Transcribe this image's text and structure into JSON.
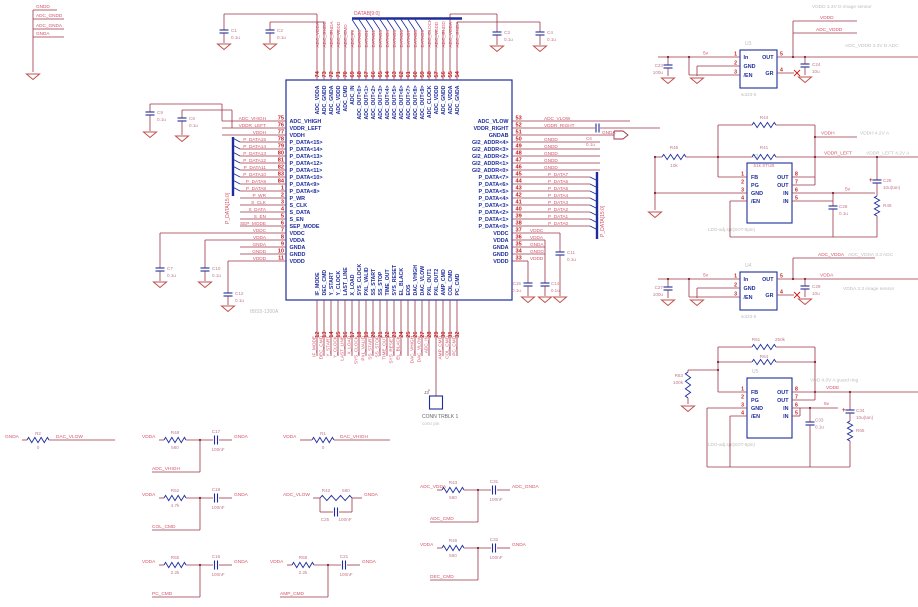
{
  "colors": {
    "wire": "#9c3347",
    "component": "#1e2d9c",
    "pin_number": "#c42222",
    "net_label": "#d4566b",
    "comment": "#bdbdbd",
    "ground": "#c0504d"
  },
  "chip": {
    "ref": "U1",
    "part": "IBIS5-1300A",
    "top_bus_label": "DATAB[9:0]",
    "left_bus_label": "P_DATA[15:0]",
    "right_bus_label": "P_DATA[15:0]",
    "left_pins": [
      {
        "num": "75",
        "name": "ADC_VHIGH",
        "net": "ADC_VHIGH"
      },
      {
        "num": "76",
        "name": "VDDR_LEFT",
        "net": "VDDR_LEFT"
      },
      {
        "num": "77",
        "name": "VDDH",
        "net": "VDDH"
      },
      {
        "num": "78",
        "name": "P_DATA<15>",
        "net": "P_DATA15"
      },
      {
        "num": "79",
        "name": "P_DATA<14>",
        "net": "P_DATA14"
      },
      {
        "num": "80",
        "name": "P_DATA<13>",
        "net": "P_DATA13"
      },
      {
        "num": "81",
        "name": "P_DATA<12>",
        "net": "P_DATA12"
      },
      {
        "num": "82",
        "name": "P_DATA<11>",
        "net": "P_DATA11"
      },
      {
        "num": "83",
        "name": "P_DATA<10>",
        "net": "P_DATA10"
      },
      {
        "num": "84",
        "name": "P_DATA<9>",
        "net": "P_DATA9"
      },
      {
        "num": "1",
        "name": "P_DATA<8>",
        "net": "P_DATA8"
      },
      {
        "num": "2",
        "name": "P_WR",
        "net": "P_WR"
      },
      {
        "num": "3",
        "name": "S_CLK",
        "net": "S_CLK"
      },
      {
        "num": "4",
        "name": "S_DATA",
        "net": "S_DATA"
      },
      {
        "num": "5",
        "name": "S_EN",
        "net": "S_EN"
      },
      {
        "num": "6",
        "name": "SEP_MODE",
        "net": "SEP_MODE"
      },
      {
        "num": "7",
        "name": "VDDC",
        "net": "VDDC"
      },
      {
        "num": "8",
        "name": "VDDA",
        "net": "VDDA"
      },
      {
        "num": "9",
        "name": "GNDA",
        "net": "GNDA"
      },
      {
        "num": "10",
        "name": "GNDD",
        "net": "GNDD"
      },
      {
        "num": "11",
        "name": "VDDD",
        "net": "VDDD"
      }
    ],
    "right_pins": [
      {
        "num": "53",
        "name": "ADC_VLOW",
        "net": "ADC_VLOW"
      },
      {
        "num": "52",
        "name": "VDDR_RIGHT",
        "net": "VDDR_RIGHT"
      },
      {
        "num": "51",
        "name": "GNDAB",
        "net": "GNDA"
      },
      {
        "num": "50",
        "name": "GI2_ADDR<4>",
        "net": "GNDD"
      },
      {
        "num": "49",
        "name": "GI2_ADDR<3>",
        "net": "GNDD"
      },
      {
        "num": "48",
        "name": "GI2_ADDR<2>",
        "net": "GNDD"
      },
      {
        "num": "47",
        "name": "GI2_ADDR<1>",
        "net": "GNDD"
      },
      {
        "num": "46",
        "name": "GI2_ADDR<0>",
        "net": "GNDD"
      },
      {
        "num": "45",
        "name": "P_DATA<7>",
        "net": "P_DATA7"
      },
      {
        "num": "44",
        "name": "P_DATA<6>",
        "net": "P_DATA6"
      },
      {
        "num": "43",
        "name": "P_DATA<5>",
        "net": "P_DATA5"
      },
      {
        "num": "42",
        "name": "P_DATA<4>",
        "net": "P_DATA4"
      },
      {
        "num": "41",
        "name": "P_DATA<3>",
        "net": "P_DATA3"
      },
      {
        "num": "40",
        "name": "P_DATA<2>",
        "net": "P_DATA2"
      },
      {
        "num": "39",
        "name": "P_DATA<1>",
        "net": "P_DATA1"
      },
      {
        "num": "38",
        "name": "P_DATA<0>",
        "net": "P_DATA0"
      },
      {
        "num": "37",
        "name": "VDDC",
        "net": "VDDC"
      },
      {
        "num": "36",
        "name": "VDDA",
        "net": "VDDA"
      },
      {
        "num": "35",
        "name": "GNDA",
        "net": "GNDA"
      },
      {
        "num": "34",
        "name": "GNDD",
        "net": "GNDD"
      },
      {
        "num": "33",
        "name": "VDDD",
        "net": "VDDD"
      }
    ],
    "top_pins": [
      {
        "num": "74",
        "name": "ADC_VDDA",
        "net": "ADC_VDDA"
      },
      {
        "num": "73",
        "name": "ADC_GNDD",
        "net": "ADC_GNDD"
      },
      {
        "num": "72",
        "name": "ADC_GNDA",
        "net": "ADC_GNDA"
      },
      {
        "num": "71",
        "name": "ADC_VDDD",
        "net": "ADC_VDDD"
      },
      {
        "num": "70",
        "name": "ADC_CMD",
        "net": "ADC_CMD"
      },
      {
        "num": "69",
        "name": "ADC_IN",
        "net": "ADC_IN"
      },
      {
        "num": "68",
        "name": "ADC_OUT<0>",
        "net": "DATAB0"
      },
      {
        "num": "67",
        "name": "ADC_OUT<1>",
        "net": "DATAB1"
      },
      {
        "num": "66",
        "name": "ADC_OUT<2>",
        "net": "DATAB2"
      },
      {
        "num": "65",
        "name": "ADC_OUT<3>",
        "net": "DATAB3"
      },
      {
        "num": "64",
        "name": "ADC_OUT<4>",
        "net": "DATAB4"
      },
      {
        "num": "63",
        "name": "ADC_OUT<5>",
        "net": "DATAB5"
      },
      {
        "num": "62",
        "name": "ADC_OUT<6>",
        "net": "DATAB6"
      },
      {
        "num": "61",
        "name": "ADC_OUT<7>",
        "net": "DATAB7"
      },
      {
        "num": "60",
        "name": "ADC_OUT<8>",
        "net": "DATAB8"
      },
      {
        "num": "59",
        "name": "ADC_OUT<9>",
        "net": "DATAB9"
      },
      {
        "num": "58",
        "name": "ADC_CLOCK",
        "net": "ADC_CLOCK"
      },
      {
        "num": "57",
        "name": "ADC_VDDD",
        "net": "ADC_VDDD"
      },
      {
        "num": "56",
        "name": "ADC_GNDD",
        "net": "ADC_GNDD"
      },
      {
        "num": "55",
        "name": "ADC_VDDA",
        "net": "ADC_VDDA"
      },
      {
        "num": "54",
        "name": "ADC_GNDA",
        "net": "ADC_GNDA"
      }
    ],
    "bottom_pins": [
      {
        "num": "12",
        "name": "IF_MODE",
        "net": "IF_MODE"
      },
      {
        "num": "13",
        "name": "DEC_CMD",
        "net": "DEC_CMD"
      },
      {
        "num": "14",
        "name": "Y_START",
        "net": "Y_START"
      },
      {
        "num": "15",
        "name": "Y_CLOCK",
        "net": "Y_CLOCK"
      },
      {
        "num": "16",
        "name": "LAST_LINE",
        "net": "LAST_LINE"
      },
      {
        "num": "17",
        "name": "X_LOAD",
        "net": "X_LOAD"
      },
      {
        "num": "18",
        "name": "SYS_CLOCK",
        "net": "SYS_CLOCK"
      },
      {
        "num": "19",
        "name": "PXL_VALID",
        "net": "PXL_VALID"
      },
      {
        "num": "20",
        "name": "SS_START",
        "net": "SS_START"
      },
      {
        "num": "21",
        "name": "SS_STOP",
        "net": "SS_STOP"
      },
      {
        "num": "22",
        "name": "TIME_OUT",
        "net": "TIME_OUT"
      },
      {
        "num": "23",
        "name": "SYS_RESET",
        "net": "SYS_RESET"
      },
      {
        "num": "24",
        "name": "EL_BLACK",
        "net": "EL_BLACK"
      },
      {
        "num": "25",
        "name": "EOS",
        "net": ""
      },
      {
        "num": "26",
        "name": "DAC_VHIGH",
        "net": "DAC_VHIGH"
      },
      {
        "num": "27",
        "name": "DAC_VLOW",
        "net": "DAC_VLOW"
      },
      {
        "num": "28",
        "name": "PXL_OUT1",
        "net": "ADC_IN"
      },
      {
        "num": "29",
        "name": "PXL_OUT2",
        "net": ""
      },
      {
        "num": "30",
        "name": "AMP_CMD",
        "net": "AMP_CMD"
      },
      {
        "num": "31",
        "name": "COL_CMD",
        "net": "COL_CMD"
      },
      {
        "num": "32",
        "name": "PC_CMD",
        "net": "PC_CMD"
      }
    ]
  },
  "ground_stack": [
    "GNDD",
    "ADC_GNDD",
    "ADC_GNDA",
    "GNDA"
  ],
  "caps": [
    {
      "ref": "C1",
      "value": "0.1u"
    },
    {
      "ref": "C2",
      "value": "0.1u"
    },
    {
      "ref": "C3",
      "value": "0.1u"
    },
    {
      "ref": "C4",
      "value": "0.1u"
    },
    {
      "ref": "C9",
      "value": "0.1u"
    },
    {
      "ref": "C8",
      "value": "0.1u"
    },
    {
      "ref": "C7",
      "value": "0.1u"
    },
    {
      "ref": "C10",
      "value": "0.1u"
    },
    {
      "ref": "C12",
      "value": "0.1u"
    },
    {
      "ref": "C15",
      "value": "0.1u"
    },
    {
      "ref": "C14",
      "value": "0.1u"
    },
    {
      "ref": "C11",
      "value": "0.1u"
    },
    {
      "ref": "C6",
      "value": "0.1u"
    }
  ],
  "offpage_arrow_net": "GNDA",
  "connector": {
    "ref": "J2",
    "name": "CONN TRBLK 1",
    "desc": "conn pin",
    "minus": "-"
  },
  "rc_filters": [
    {
      "kind": "series",
      "left": "GNDA",
      "r": "R2",
      "rv": "0",
      "right": "DAC_VLOW"
    },
    {
      "kind": "series",
      "left": "VDDA",
      "r": "R1",
      "rv": "0",
      "right": "DAC_VHIGH"
    },
    {
      "kind": "shunt",
      "left": "VDDA",
      "r": "R48",
      "rv": "560",
      "c": "C17",
      "cv": "100nF",
      "right": "GNDA",
      "branch": "ADC_VHIGH"
    },
    {
      "kind": "shunt",
      "left": "VDDA",
      "r": "R52",
      "rv": "4.7k",
      "c": "C18",
      "cv": "100nF",
      "right": "GNDA",
      "branch": "COL_CMD"
    },
    {
      "kind": "shunt",
      "left": "VDDA",
      "r": "R55",
      "rv": "2.2k",
      "c": "C16",
      "cv": "100nF",
      "right": "GNDA",
      "branch": "PC_CMD"
    },
    {
      "kind": "parallel",
      "left": "ADC_VLOW",
      "r": "R42",
      "rv": "560",
      "c": "C25",
      "cv": "100nF",
      "right": "GNDA"
    },
    {
      "kind": "shunt",
      "left": "VDDA",
      "r": "R58",
      "rv": "2.2k",
      "c": "C21",
      "cv": "100nF",
      "right": "GNDA",
      "branch": "AMP_CMD"
    },
    {
      "kind": "shunt",
      "left": "ADC_VDDA",
      "r": "R43",
      "rv": "560",
      "c": "C31",
      "cv": "100nF",
      "right": "ADC_GNDA",
      "branch": "ADC_CMD"
    },
    {
      "kind": "shunt",
      "left": "VDDA",
      "r": "R46",
      "rv": "560",
      "c": "C32",
      "cv": "100nF",
      "right": "GNDA",
      "branch": "DEC_CMD"
    }
  ],
  "regulators": [
    {
      "ref": "U3",
      "type": "sot23",
      "footprint": "sot23-5",
      "input_net": "5v",
      "pin_labels": {
        "p1": "In",
        "p2": "GND",
        "p3": "/EN",
        "p4": "GR",
        "p5": "OUT"
      },
      "cin": {
        "ref": "C23",
        "value": "100u"
      },
      "cout": {
        "ref": "C24",
        "value": "10u"
      },
      "outputs": [
        {
          "net": "VDDD",
          "comment": "VDDD 3.3V D image sensor"
        },
        {
          "net": "ADC_VDDD",
          "comment": "ADC_VDDD 3.3V D ADC"
        }
      ]
    },
    {
      "ref": "U2",
      "type": "ldo8",
      "footprint": "LDO-adj.spt(SOT-8pin)",
      "input_net": "5v",
      "pin_labels": {
        "p1": "FB",
        "p2": "PG",
        "p3": "GND",
        "p4": "/EN",
        "p5": "IN",
        "p6": "IN",
        "p7": "OUT",
        "p8": "OUT"
      },
      "cin": {
        "ref": "C28",
        "value": "0.1u"
      },
      "cout": {
        "ref": "C26",
        "value": "10u(tan)"
      },
      "rout": {
        "ref": "R49",
        "value": ""
      },
      "resistors": [
        {
          "ref": "R44",
          "value": ""
        },
        {
          "ref": "R41",
          "value": "51k STUB"
        },
        {
          "ref": "R45",
          "value": "10k"
        }
      ],
      "outputs": [
        {
          "net": "VDDH",
          "comment": "VDDH 4.2V A"
        },
        {
          "net": "VDDR_LEFT",
          "comment": "VDDR_LEFT 4.2V A"
        }
      ]
    },
    {
      "ref": "U4",
      "type": "sot23",
      "footprint": "sot23-5",
      "input_net": "5v",
      "pin_labels": {
        "p1": "In",
        "p2": "GND",
        "p3": "/EN",
        "p4": "GR",
        "p5": "OUT"
      },
      "cin": {
        "ref": "C27",
        "value": "100u"
      },
      "cout": {
        "ref": "C29",
        "value": "10u"
      },
      "outputs": [
        {
          "net": "ADC_VDDA",
          "comment": "ADC_VDDA 3.3 ADC"
        },
        {
          "net": "VDDA",
          "comment": "VDDA 3.3 image sensor"
        }
      ]
    },
    {
      "ref": "U5",
      "type": "ldo8",
      "footprint": "LDO-adj.spt(SOT-8pin)",
      "input_net": "5v",
      "pin_labels": {
        "p1": "FB",
        "p2": "PG",
        "p3": "GND",
        "p4": "/EN",
        "p5": "IN",
        "p6": "IN",
        "p7": "OUT",
        "p8": "OUT"
      },
      "cin": {
        "ref": "C33",
        "value": "0.1u"
      },
      "cout": {
        "ref": "C34",
        "value": "10u(tan)"
      },
      "rout": {
        "ref": "R65",
        "value": ""
      },
      "resistors": [
        {
          "ref": "R61",
          "value": "250k"
        },
        {
          "ref": "R64",
          "value": ""
        },
        {
          "ref": "R63",
          "value": "100k"
        }
      ],
      "outputs": [
        {
          "net": "VDDE",
          "comment": "VDD 4.0V A guard ring"
        }
      ]
    }
  ]
}
